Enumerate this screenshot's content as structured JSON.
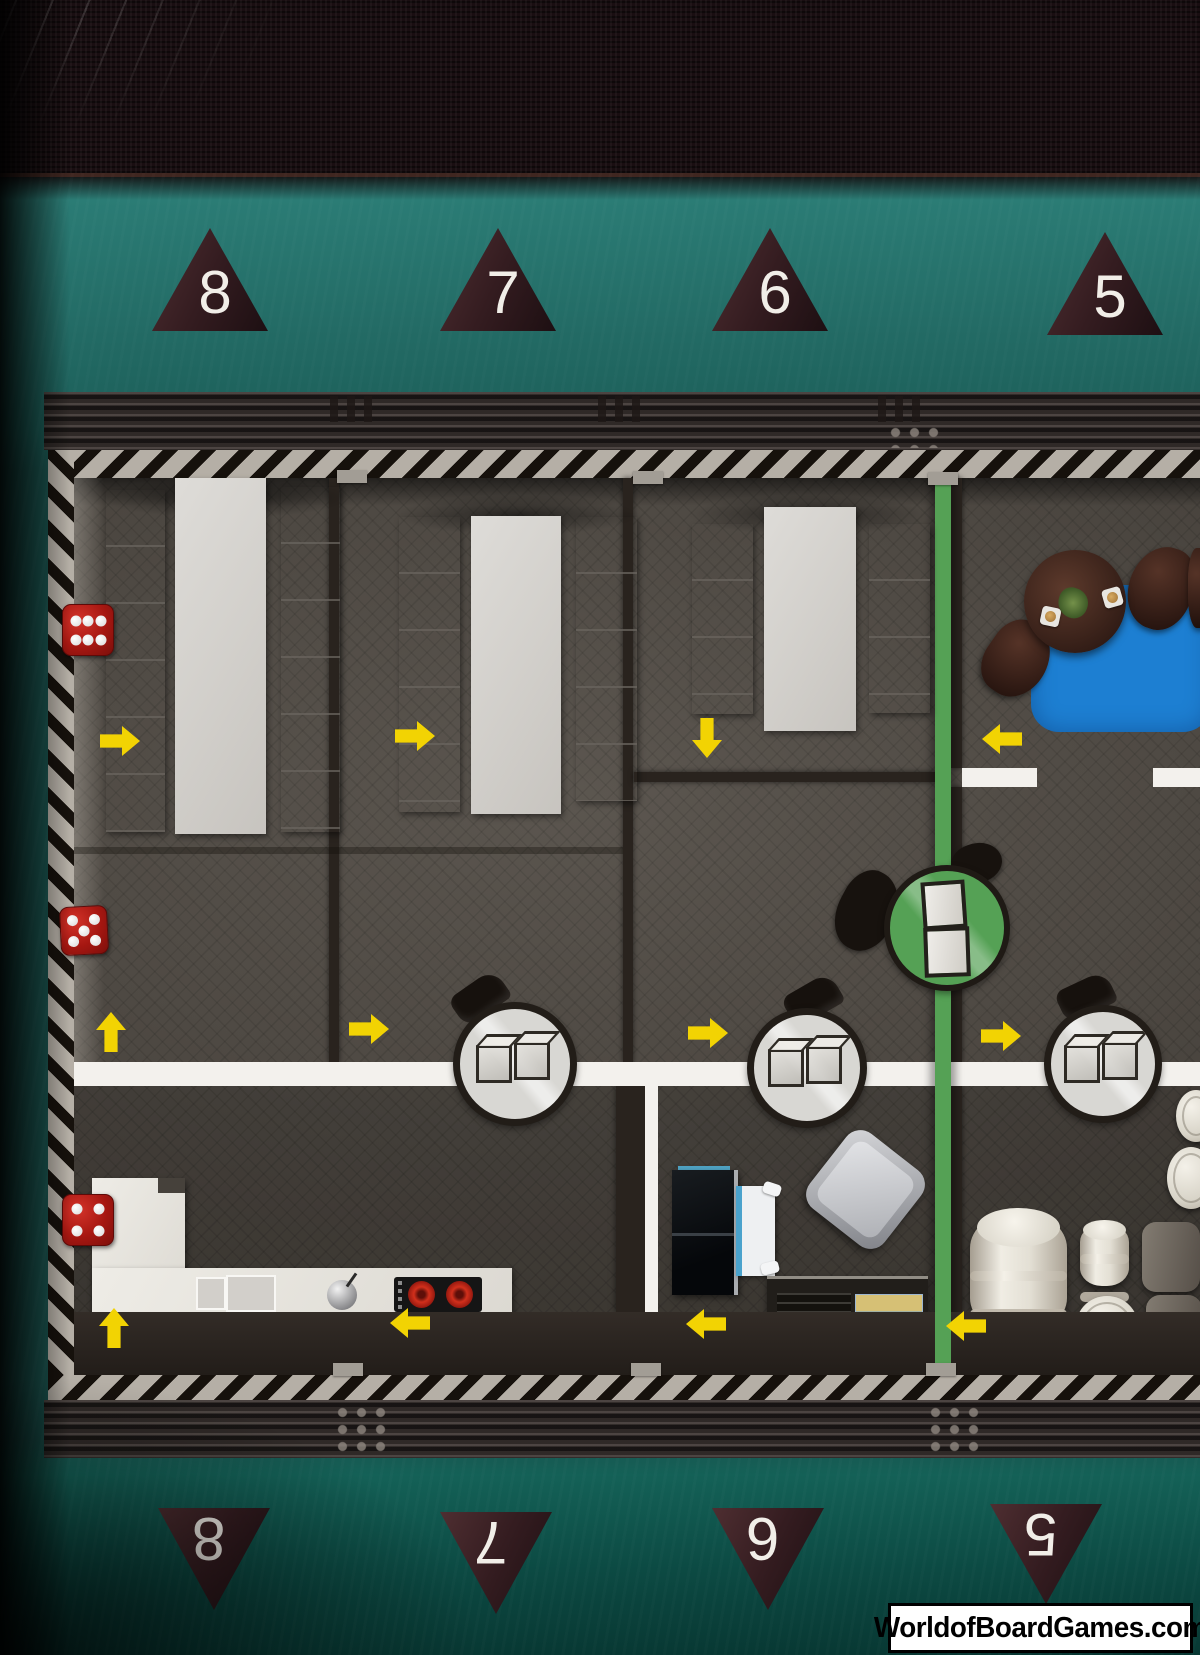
{
  "scene": {
    "description": "Photographed board-game map: top-down ship/bunker deck plan on teal background, shrink-wrapped box",
    "width_px": 1200,
    "height_px": 1655
  },
  "markers_top": [
    {
      "label": "8"
    },
    {
      "label": "7"
    },
    {
      "label": "6"
    },
    {
      "label": "5"
    }
  ],
  "markers_bottom": [
    {
      "label": "8"
    },
    {
      "label": "7"
    },
    {
      "label": "6"
    },
    {
      "label": "5"
    }
  ],
  "watermark": {
    "text": "WorldofBoardGames.com"
  },
  "dice": [
    {
      "id": "die-top",
      "pips": 6,
      "color": "#b5201a"
    },
    {
      "id": "die-middle",
      "pips": 5,
      "color": "#b5201a"
    },
    {
      "id": "die-bottom",
      "pips": 4,
      "color": "#b5201a"
    }
  ],
  "arrows": [
    {
      "direction": "right",
      "area": "dormitory-1-upper"
    },
    {
      "direction": "right",
      "area": "dormitory-2-upper"
    },
    {
      "direction": "down",
      "area": "dormitory-3-upper"
    },
    {
      "direction": "left",
      "area": "lounge"
    },
    {
      "direction": "up",
      "area": "dormitory-1-lower"
    },
    {
      "direction": "right",
      "area": "dormitory-2-lower"
    },
    {
      "direction": "right",
      "area": "hall-table-2"
    },
    {
      "direction": "right",
      "area": "hall-table-3"
    },
    {
      "direction": "up",
      "area": "kitchen"
    },
    {
      "direction": "left",
      "area": "kitchen-stove"
    },
    {
      "direction": "left",
      "area": "cabin"
    },
    {
      "direction": "left",
      "area": "storage"
    }
  ],
  "rooms": [
    {
      "name": "dormitory-1",
      "furniture": [
        "bunk-shelves"
      ]
    },
    {
      "name": "dormitory-2",
      "furniture": [
        "bunk-shelves"
      ]
    },
    {
      "name": "dormitory-3",
      "furniture": [
        "bunk-shelves"
      ]
    },
    {
      "name": "lounge",
      "furniture": [
        "blue-rug",
        "round-coffee-table",
        "plant",
        "2-cups",
        "3-chairs"
      ]
    },
    {
      "name": "kitchen",
      "furniture": [
        "l-counter",
        "sink",
        "faucet",
        "stove"
      ]
    },
    {
      "name": "cabin",
      "furniture": [
        "dark-cabinet",
        "bed",
        "armchair",
        "map-console"
      ]
    },
    {
      "name": "storage",
      "furniture": [
        "large-barrel",
        "small-barrel",
        "barrel-lids",
        "crates"
      ]
    }
  ],
  "round_tables": {
    "count": 3,
    "cubes_per_table": 2,
    "note": "white round tables with dark ring sitting on main corridor"
  },
  "elevator": {
    "shape": "green-circle",
    "contents": "white cargo boxes",
    "line": "vertical green stripe"
  },
  "colors": {
    "teal_background": "#226b65",
    "floor": "#4f4942",
    "corridor_white": "#f3f1ed",
    "hazard_light": "#b5afa6",
    "hazard_dark": "#16110c",
    "green_stripe": "#55a155",
    "arrow_yellow": "#f2d303",
    "die_red": "#b5201a",
    "rug_blue": "#1d7fd2",
    "triangle_brown": "#341c20",
    "barrel_cream": "#e9e5da"
  }
}
